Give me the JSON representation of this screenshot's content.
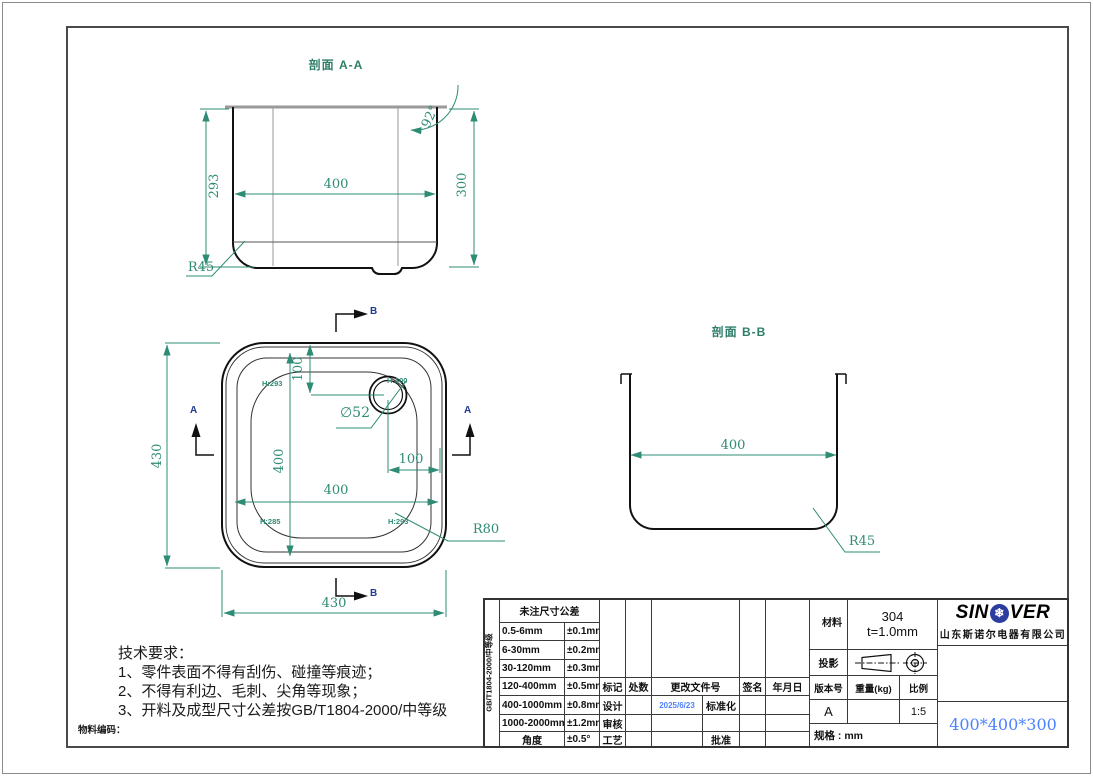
{
  "colors": {
    "dim_green": "#2e8b74",
    "accent_blue": "#4d82ff",
    "logo_blue": "#2b3d9e",
    "line_black": "#111111",
    "line_gray": "#9a9a9a"
  },
  "views": {
    "section_aa": {
      "title": "剖面 A-A",
      "dim_left": "293",
      "dim_width": "400",
      "dim_right": "300",
      "dim_angle": "92°",
      "dim_radius": "R45"
    },
    "plan": {
      "dim_outer_h": "430",
      "dim_outer_w": "430",
      "dim_inner_v": "400",
      "dim_inner_h": "400",
      "dim_hole_v": "100",
      "dim_hole_h": "100",
      "hole_dia": "∅52",
      "corner_radius": "R80",
      "h_tl": "H:293",
      "h_tr": "H:300",
      "h_bl": "H:285",
      "h_br": "H:293",
      "marker_a": "A",
      "marker_b": "B"
    },
    "section_bb": {
      "title": "剖面 B-B",
      "dim_width": "400",
      "dim_radius": "R45"
    }
  },
  "tech_notes": {
    "title": "技术要求：",
    "items": [
      "1、零件表面不得有刮伤、碰撞等痕迹；",
      "2、不得有利边、毛刺、尖角等现象；",
      "3、开料及成型尺寸公差按GB/T1804-2000/中等级"
    ],
    "material_code_label": "物料编码："
  },
  "title_block": {
    "tolerance_standard_vertical": "GB/T1804-2000/中等级",
    "tolerance_header": "未注尺寸公差",
    "tolerance_rows": [
      {
        "range": "0.5-6mm",
        "tol": "±0.1mm"
      },
      {
        "range": "6-30mm",
        "tol": "±0.2mm"
      },
      {
        "range": "30-120mm",
        "tol": "±0.3mm"
      },
      {
        "range": "120-400mm",
        "tol": "±0.5mm"
      },
      {
        "range": "400-1000mm",
        "tol": "±0.8mm"
      },
      {
        "range": "1000-2000mm",
        "tol": "±1.2mm"
      },
      {
        "range": "角度",
        "tol": "±0.5°"
      }
    ],
    "revision": {
      "col_mark": "标记",
      "col_count": "处数",
      "col_doc": "更改文件号",
      "col_sign": "签名",
      "col_date": "年月日",
      "design": "设计",
      "design_date": "2025/6/23",
      "standardization": "标准化",
      "review": "审核",
      "process": "工艺",
      "approve": "批准"
    },
    "info": {
      "material_label": "材料",
      "material_value": "304",
      "thickness": "t=1.0mm",
      "projection_label": "投影",
      "version_label": "版本号",
      "weight_label": "重量(kg)",
      "scale_label": "比例",
      "version_value": "A",
      "scale_value": "1:5",
      "spec": "规格 : mm",
      "part_size": "400*400*300"
    },
    "brand": {
      "logo_left": "SIN",
      "logo_right": "VER",
      "snowflake": "❄",
      "company": "山东斯诺尔电器有限公司"
    }
  }
}
